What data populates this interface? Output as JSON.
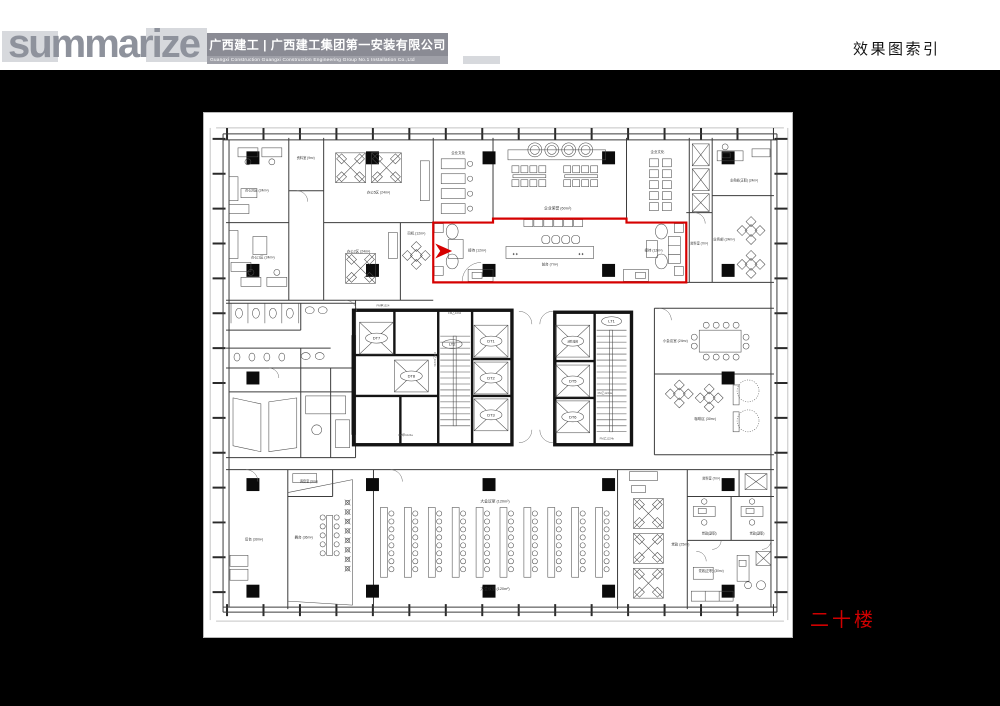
{
  "header": {
    "logo": "summarize",
    "company_cn": "广西建工 | 广西建工集团第一安装有限公司",
    "company_en": "Guangxi Construction      Guangxi Construction Engineering Group No.1 Installation Co.,Ltd",
    "page_title": "效果图索引"
  },
  "floor_tag": "二十楼",
  "colors": {
    "highlight_red": "#d60000",
    "paper": "#ffffff",
    "background": "#000000"
  },
  "plan": {
    "rooms": {
      "office6": "办公6区 (24m²)",
      "office5": "办公5区 (24m²)",
      "office1": "办公1区 (24m²)",
      "office2": "办公2区 (24m²)",
      "ziliao_top": "资料室 (9m²)",
      "qywh_left": "企业文化",
      "qyry": "企业荣誉 (60m²)",
      "qywh_right": "企业文化",
      "ywb_zhengzhi": "业务部(正职) (24m²)",
      "ywb": "业务部 (24m²)",
      "ziliao_mid": "资料室 (7m²)",
      "siji": "司机 (12m²)",
      "jiedai_left": "接待 (12m²)",
      "qiantai": "前台 (7m²)",
      "jiedai_right": "接待 (12m²)",
      "xiaohuiyishi": "小会议室 (24m²)",
      "kafeiqu": "咖啡区 (30m²)",
      "tiaoyinshi": "调音室 (9m²)",
      "houtai": "后台 (30m²)",
      "wutai": "舞台 (36m²)",
      "dahuiyishi_top": "大会议室 (120m²)",
      "dahuiyishi_bottom": "大会议室 (120m²)",
      "dangzheng": "党政 (25m²)",
      "ziliao_bottom": "资料室 (7m²)",
      "dz_fuzhi_1": "党政(副职)",
      "dz_fuzhi_2": "党政(副职)",
      "dz_zhengzhi": "党政(正职) (30m²)"
    },
    "elevators": {
      "dt1": "DT1",
      "dt2": "DT2",
      "dt3": "DT3",
      "dt5": "DT5",
      "dt6": "DT6",
      "dt7": "DT7",
      "dt8": "DT8",
      "fire": "消防电梯",
      "lt1": "LT1",
      "lt2": "LT2"
    },
    "door_codes": {
      "c1": "FM甲1524",
      "c2": "FM乙1034",
      "c3": "FM乙1024b",
      "c4": "FM甲1024a",
      "c5": "FM乙1224a",
      "c6": "FM乙1224b"
    },
    "reception_marks": "✦✦"
  }
}
